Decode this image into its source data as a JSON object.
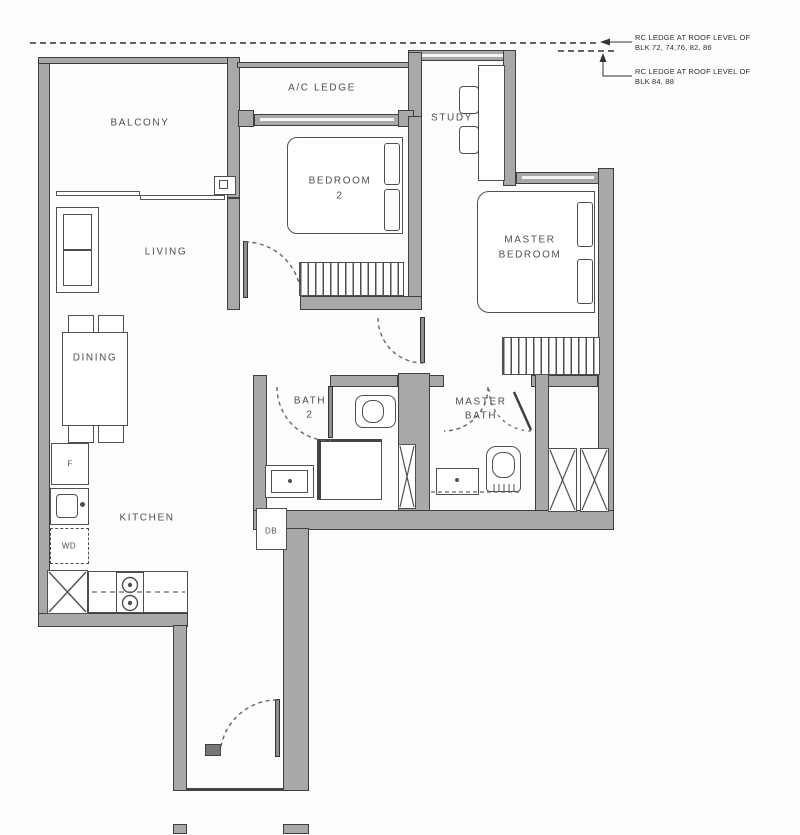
{
  "title": "2-bedroom unit floor plan",
  "annotations": {
    "rc1": {
      "l1": "RC LEDGE AT ROOF LEVEL OF",
      "l2": "BLK 72, 74,76, 82, 86"
    },
    "rc2": {
      "l1": "RC LEDGE AT ROOF LEVEL OF",
      "l2": "BLK 84, 88"
    }
  },
  "rooms": {
    "balcony": "BALCONY",
    "ac_ledge": "A/C LEDGE",
    "bedroom2": {
      "l1": "BEDROOM",
      "l2": "2"
    },
    "study": "STUDY",
    "master_bedroom": {
      "l1": "MASTER",
      "l2": "BEDROOM"
    },
    "living": "LIVING",
    "dining": "DINING",
    "kitchen": "KITCHEN",
    "bath2": {
      "l1": "BATH",
      "l2": "2"
    },
    "master_bath": {
      "l1": "MASTER",
      "l2": "BATH"
    }
  },
  "appliances": {
    "fridge": "F",
    "washer_dryer": "WD",
    "db": "DB"
  },
  "colors": {
    "wall": "#a8a8a8",
    "line": "#3f3f3f",
    "furn": "#4f4f4f",
    "label": "#4f4f4f"
  }
}
